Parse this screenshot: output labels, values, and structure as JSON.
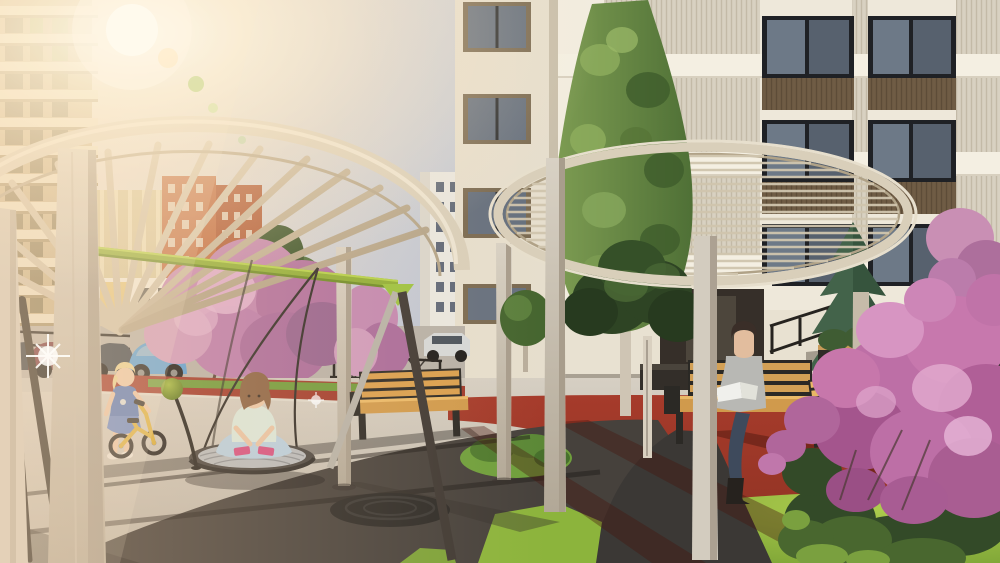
{
  "scene": {
    "title": "Sunlit residential courtyard playground — architectural rendering",
    "objects": {
      "left_building": "beige high-rise with balcony slabs",
      "background_buildings": "orange brick towers, beige mid-rise, white tower",
      "right_building": "white residential tower, black-framed windows, wood spandrels, ribbed panels",
      "entrance": "recessed lobby door with stair and black railing",
      "pergola_left": "round timber pergola with radial slats on square posts",
      "pergola_right": "round timber pergola with parallel slats on square posts",
      "swing_set": "green-beam swing frame with round nest swing",
      "nest_swing": "rope-edged basket swing",
      "balance_bike": "yellow toddler balance bike",
      "benches": "wooden benches with black steel frames",
      "planter": "dark planter box with shrubs",
      "blossom_trees": "pink blossoming trees along street",
      "foreground_bush": "magenta flowering shrub, bottom right",
      "conifer": "blue spruce by entrance",
      "columnar_trees": "tall clipped green columnar trees",
      "ground": "dark rubber safety surface, red rubber track, bright lawn patches, concrete paving",
      "cars": "parked cars on background street",
      "street_fence": "black lattice fence",
      "manhole": "dark rubber mound",
      "lamp_ball": "green sphere ornament on curved stem",
      "sun_flare": "warm lens flare from upper left"
    },
    "figures": {
      "girl_on_swing": "girl sitting cross-legged on nest swing, mint shirt, pink shoes",
      "toddler_on_bike": "blonde toddler in blue dress with yellow balance bike",
      "woman_reading": "woman in grey poncho reading a book on bench"
    },
    "figure_count": 3
  },
  "palette": {
    "sky_right": "#a6b4cc",
    "sun_warm": "#fff3d8",
    "road": "#b7b1a8",
    "pavement": "#d0c9bd",
    "rubber_dark": "#46413c",
    "rubber_red": "#a63b2b",
    "path_dark": "#3b3835",
    "grass_right": "#9ac33f",
    "grass_wedge": "#8cb43c",
    "grass_strip": "#6f9a3a",
    "orange_patch": "#b97435",
    "swing_green": "#8fae35",
    "pergola_wood": "#d9cfba",
    "post_wood": "#d2c9ba",
    "bench_wood": "#d09a4c",
    "bench_frame": "#2b2925",
    "nest_mesh": "#b7babc",
    "blossom": "#c789b2",
    "bush_pink": "#bd6fa6",
    "conifer": "#36543d",
    "laurel_dark": "#2e4424",
    "car_blue": "#5b9fd4",
    "window_glass": "#5a6472",
    "spandrel_brown": "#6f5c45",
    "left_building_wall": "#c9b48d",
    "right_building_wall": "#eee8da"
  }
}
